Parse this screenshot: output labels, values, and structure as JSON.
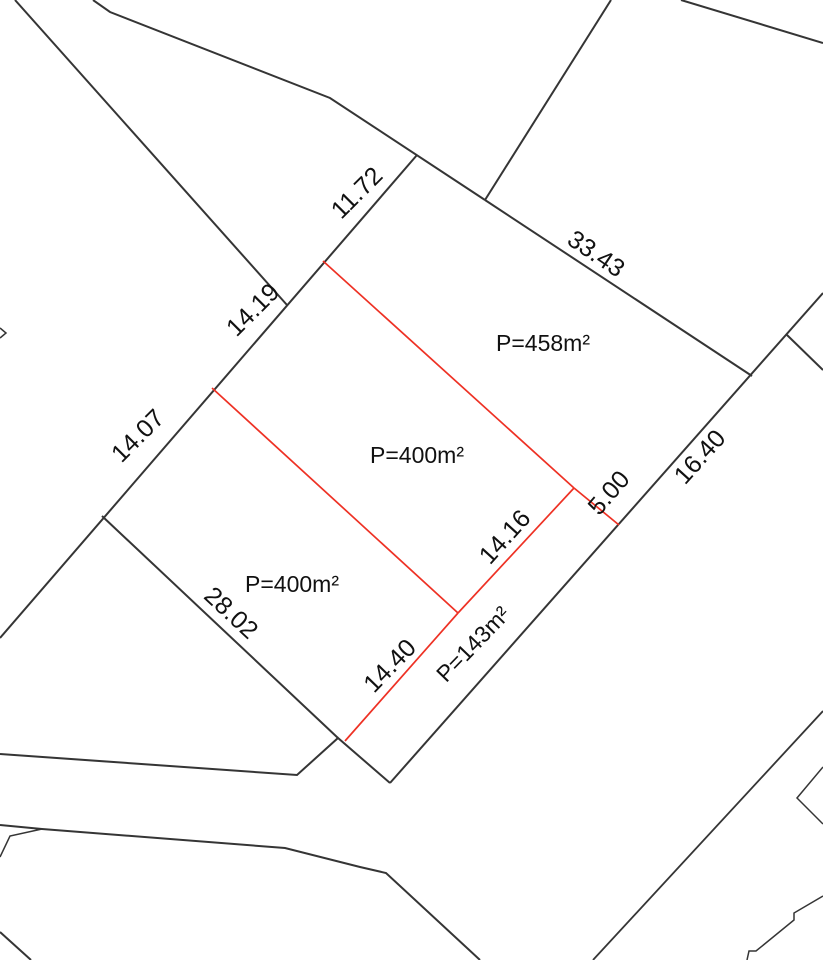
{
  "canvas": {
    "width": 823,
    "height": 960,
    "background": "#ffffff"
  },
  "styles": {
    "parcel_line_color": "#353535",
    "subdivision_line_color": "#ee3124",
    "label_color": "#111111",
    "dimension_font_px": 25,
    "area_font_px": 23,
    "main_line_width": 2,
    "thin_line_width": 1.5,
    "red_line_width": 1.7
  },
  "parcel_areas": [
    "P=458m²",
    "P=400m²",
    "P=400m²",
    "P=143m²"
  ],
  "dimension_values": [
    "11.72",
    "33.43",
    "14.19",
    "14.07",
    "16.40",
    "5.00",
    "14.16",
    "28.02",
    "14.40"
  ],
  "lines": [
    {
      "name": "west-spur-line",
      "layer": "black",
      "width": 2,
      "points": [
        [
          15,
          0
        ],
        [
          287,
          305
        ]
      ]
    },
    {
      "name": "north-boundary-line",
      "layer": "black",
      "width": 2,
      "points": [
        [
          93,
          0
        ],
        [
          110,
          12
        ],
        [
          330,
          98
        ],
        [
          485,
          200
        ]
      ]
    },
    {
      "name": "north-spur-line",
      "layer": "black",
      "width": 2,
      "points": [
        [
          611,
          0
        ],
        [
          485,
          200
        ]
      ]
    },
    {
      "name": "edge-33-43-line",
      "layer": "black",
      "width": 2,
      "points": [
        [
          485,
          200
        ],
        [
          752,
          376
        ]
      ]
    },
    {
      "name": "northeast-spur-line",
      "layer": "black",
      "width": 2,
      "points": [
        [
          681,
          0
        ],
        [
          823,
          43
        ]
      ]
    },
    {
      "name": "west-edge-14-19-14-07-line",
      "layer": "black",
      "width": 2,
      "points": [
        [
          417,
          155
        ],
        [
          0,
          638
        ]
      ]
    },
    {
      "name": "road-edge-16-40-line",
      "layer": "black",
      "width": 2,
      "points": [
        [
          823,
          293
        ],
        [
          390,
          783
        ]
      ]
    },
    {
      "name": "road-branch-line",
      "layer": "black",
      "width": 2,
      "points": [
        [
          787,
          335
        ],
        [
          823,
          370
        ]
      ]
    },
    {
      "name": "edge-28-02-line",
      "layer": "black",
      "width": 2,
      "points": [
        [
          102,
          516
        ],
        [
          338,
          738
        ]
      ]
    },
    {
      "name": "street-north-edge-line",
      "layer": "black",
      "width": 2,
      "points": [
        [
          0,
          754
        ],
        [
          297,
          775
        ],
        [
          338,
          738
        ],
        [
          390,
          783
        ]
      ]
    },
    {
      "name": "street-south-edge-line",
      "layer": "black",
      "width": 2,
      "points": [
        [
          0,
          825
        ],
        [
          42,
          829
        ],
        [
          285,
          848
        ],
        [
          360,
          867
        ],
        [
          386,
          873
        ],
        [
          480,
          960
        ]
      ]
    },
    {
      "name": "street-south-sliver-line",
      "layer": "black",
      "width": 1.5,
      "points": [
        [
          0,
          857
        ],
        [
          10,
          836
        ],
        [
          42,
          829
        ]
      ]
    },
    {
      "name": "southwest-corner-cut-line",
      "layer": "black",
      "width": 2,
      "points": [
        [
          0,
          932
        ],
        [
          31,
          960
        ]
      ]
    },
    {
      "name": "southeast-parcel-edge-line",
      "layer": "black",
      "width": 1.8,
      "points": [
        [
          823,
          711
        ],
        [
          593,
          960
        ]
      ]
    },
    {
      "name": "east-notch-line",
      "layer": "black",
      "width": 1.5,
      "points": [
        [
          823,
          767
        ],
        [
          797,
          798
        ],
        [
          823,
          824
        ]
      ]
    },
    {
      "name": "southeast-steps-line",
      "layer": "black",
      "width": 1.5,
      "points": [
        [
          823,
          896
        ],
        [
          794,
          913
        ],
        [
          794,
          920
        ],
        [
          756,
          951
        ],
        [
          749,
          951
        ],
        [
          747,
          960
        ]
      ]
    },
    {
      "name": "west-edge-mark-line",
      "layer": "black",
      "width": 1.5,
      "points": [
        [
          0,
          328
        ],
        [
          6,
          333
        ],
        [
          0,
          338
        ]
      ]
    },
    {
      "name": "subdivision-upper-line",
      "layer": "red",
      "width": 1.7,
      "points": [
        [
          323,
          261
        ],
        [
          574,
          488
        ]
      ]
    },
    {
      "name": "subdivision-5-00-line",
      "layer": "red",
      "width": 1.7,
      "points": [
        [
          574,
          488
        ],
        [
          619,
          525
        ]
      ]
    },
    {
      "name": "subdivision-14-16-line",
      "layer": "red",
      "width": 1.7,
      "points": [
        [
          574,
          488
        ],
        [
          458,
          613
        ]
      ]
    },
    {
      "name": "subdivision-middle-line",
      "layer": "red",
      "width": 1.7,
      "points": [
        [
          212,
          388
        ],
        [
          458,
          613
        ]
      ]
    },
    {
      "name": "subdivision-14-40-line",
      "layer": "red",
      "width": 1.7,
      "points": [
        [
          458,
          613
        ],
        [
          345,
          741
        ]
      ]
    }
  ],
  "labels": [
    {
      "name": "dim-label-11-72",
      "text": "11.72",
      "x": 357,
      "y": 193,
      "rot": -45,
      "kind": "dim"
    },
    {
      "name": "dim-label-33-43",
      "text": "33.43",
      "x": 596,
      "y": 254,
      "rot": 34,
      "kind": "dim"
    },
    {
      "name": "dim-label-14-19",
      "text": "14.19",
      "x": 253,
      "y": 310,
      "rot": -45,
      "kind": "dim"
    },
    {
      "name": "dim-label-14-07",
      "text": "14.07",
      "x": 138,
      "y": 436,
      "rot": -45,
      "kind": "dim"
    },
    {
      "name": "dim-label-16-40",
      "text": "16.40",
      "x": 700,
      "y": 457,
      "rot": -48,
      "kind": "dim"
    },
    {
      "name": "dim-label-5-00",
      "text": "5.00",
      "x": 609,
      "y": 493,
      "rot": -49,
      "kind": "dim"
    },
    {
      "name": "dim-label-14-16",
      "text": "14.16",
      "x": 505,
      "y": 537,
      "rot": -48,
      "kind": "dim"
    },
    {
      "name": "dim-label-28-02",
      "text": "28.02",
      "x": 231,
      "y": 613,
      "rot": 43,
      "kind": "dim"
    },
    {
      "name": "dim-label-14-40",
      "text": "14.40",
      "x": 390,
      "y": 666,
      "rot": -46,
      "kind": "dim"
    },
    {
      "name": "area-label-458",
      "text": "P=458m²",
      "x": 543,
      "y": 343,
      "rot": 0,
      "kind": "area"
    },
    {
      "name": "area-label-400-mid",
      "text": "P=400m²",
      "x": 417,
      "y": 455,
      "rot": 0,
      "kind": "area"
    },
    {
      "name": "area-label-400-sw",
      "text": "P=400m²",
      "x": 292,
      "y": 584,
      "rot": 0,
      "kind": "area"
    },
    {
      "name": "area-label-143",
      "text": "P=143m²",
      "x": 473,
      "y": 644,
      "rot": -46,
      "kind": "area"
    }
  ]
}
